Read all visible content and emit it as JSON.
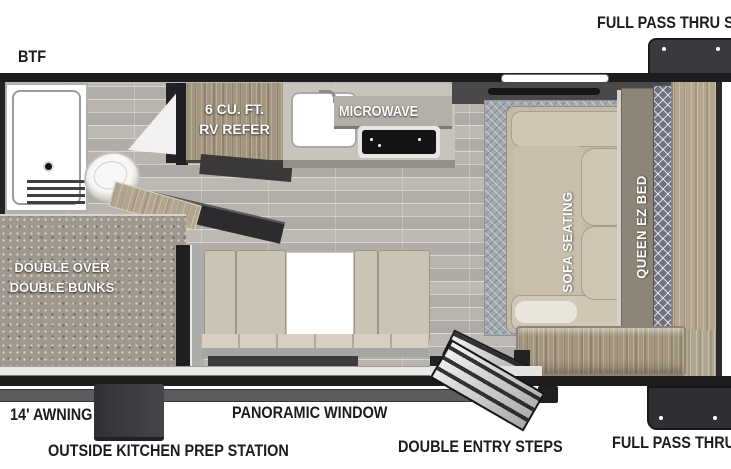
{
  "figure": {
    "kind": "travel-trailer-floor-plan",
    "orientation": "side cutaway top view, hitch side right"
  },
  "labels": {
    "btf": "BTF",
    "storage_top": "FULL PASS THRU STO",
    "storage_bottom": "FULL PASS THRU ST",
    "awning": "14' AWNING",
    "outside_kitchen": "OUTSIDE KITCHEN PREP STATION",
    "panoramic_window": "PANORAMIC WINDOW",
    "entry_steps": "DOUBLE ENTRY STEPS",
    "bunks_line1": "DOUBLE OVER",
    "bunks_line2": "DOUBLE BUNKS",
    "refer_line1": "6 CU. FT.",
    "refer_line2": "RV REFER",
    "microwave": "MICROWAVE",
    "sofa": "SOFA SEATING",
    "queen_bed": "QUEEN EZ BED"
  },
  "colors": {
    "wall": "#1c1c1e",
    "floor": "#b5b1ac",
    "storage_box": "#38383c",
    "refer_wood": "#a2967f",
    "platform_wood": "#b2a68f",
    "bunk_carpet": "#a0978e",
    "sofa_cushion": "#cbc3b3",
    "rug": "#a4a8af",
    "bed_runner": "#6e7380",
    "label_text": "#1c1c1e"
  }
}
